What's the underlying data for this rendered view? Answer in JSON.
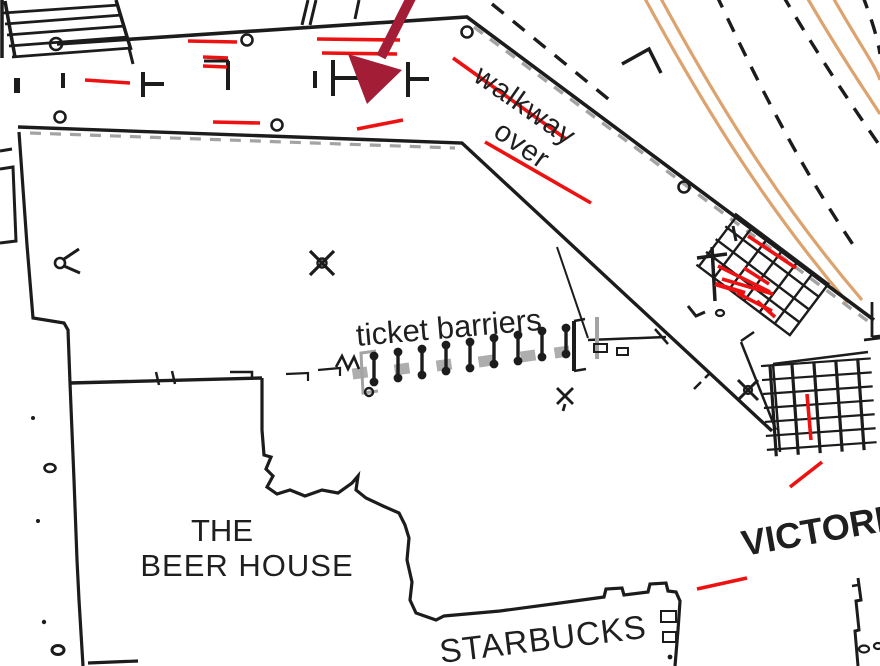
{
  "title": "Station concourse floor plan with walkway, ticket barriers and shops",
  "labels": {
    "walkway_line1": "walkway",
    "walkway_line2": "over",
    "ticket_barriers": "ticket barriers",
    "beer_house_line1": "THE",
    "beer_house_line2": "BEER HOUSE",
    "starbucks": "STARBUCKS",
    "station_name": "VICTORIA"
  },
  "colors": {
    "linework_black": "#1c1c1c",
    "annotation_red": "#ee1111",
    "arrow_crimson": "#a41d36",
    "track_tan": "#dca36f",
    "shadow_gray": "#a3a3a3",
    "background": "#ffffff"
  },
  "icons": {
    "direction_arrow": "down-left-arrow",
    "upper_crosshatch": "escalator-stairs-grid",
    "lower_crosshatch": "stairs-grid",
    "ladder": "top-left-stairs"
  }
}
